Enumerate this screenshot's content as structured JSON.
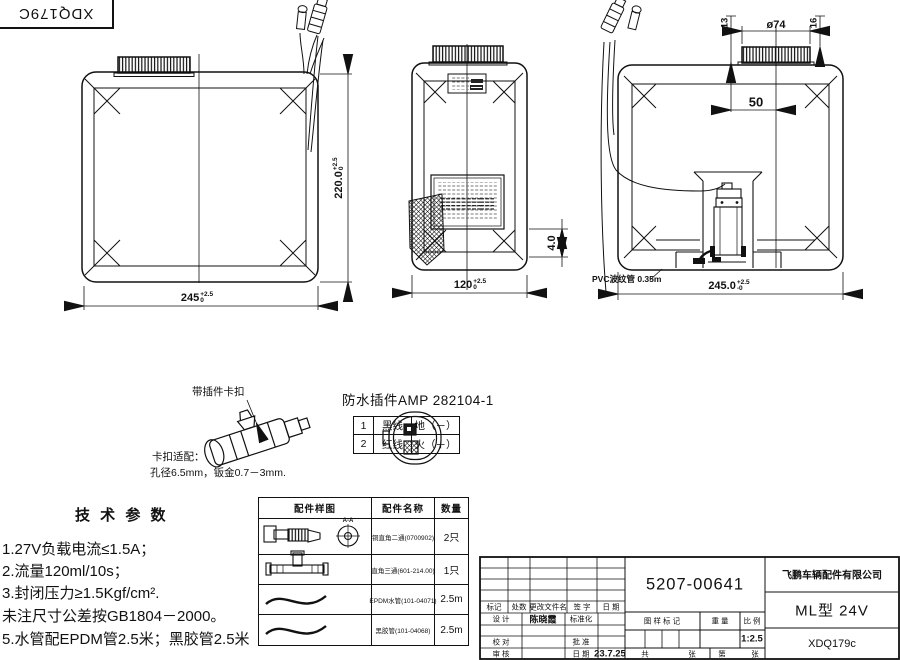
{
  "doc_code": "XDQ179C",
  "views": {
    "front": {
      "dim_width": "245",
      "dim_width_tol_up": "+2.5",
      "dim_width_tol_dn": "0",
      "dim_height": "220.0",
      "dim_height_tol_up": "+2.5",
      "dim_height_tol_dn": "0"
    },
    "side": {
      "dim_width": "120",
      "dim_width_tol_up": "+2.5",
      "dim_width_tol_dn": "0",
      "dim_foot": "4.0"
    },
    "rear": {
      "dim_offset_left": "13",
      "dim_cap_dia": "ø74",
      "dim_offset_right": "16",
      "dim_cap_center": "50",
      "dim_width": "245.0",
      "dim_width_tol_up": "+2.5",
      "dim_width_tol_dn": "-0",
      "pvc_note": "PVC波纹管 0.35m"
    }
  },
  "connector": {
    "clip_label": "带插件卡扣",
    "title": "防水插件AMP 282104-1",
    "pin_rows": [
      {
        "no": "1",
        "wire": "黑线",
        "polarity": "地（－）"
      },
      {
        "no": "2",
        "wire": "红线",
        "polarity": "火（＋）"
      }
    ],
    "fit_title": "卡扣适配：",
    "fit_spec": "孔径6.5mm，钣金0.7－3mm."
  },
  "tech_params": {
    "title": "技 术 参 数",
    "lines": [
      "1.27V负载电流≤1.5A；",
      "2.流量120ml/10s；",
      "3.封闭压力≥1.5Kgf/cm².",
      "未注尺寸公差按GB1804－2000。",
      "5.水管配EPDM管2.5米；黑胶管2.5米"
    ]
  },
  "parts_table": {
    "col_sample": "配件样图",
    "col_name": "配件名称",
    "col_qty": "数量",
    "section_label": "A-A",
    "rows": [
      {
        "name": "铜直角二通(0700902)",
        "qty": "2只"
      },
      {
        "name": "直角三通(601-214.00)",
        "qty": "1只"
      },
      {
        "name": "EPDM水管(101-04071)",
        "qty": "2.5m"
      },
      {
        "name": "黑胶管(101-04068)",
        "qty": "2.5m"
      }
    ]
  },
  "title_block": {
    "drawing_no": "5207-00641",
    "company": "飞鹏车辆配件有限公司",
    "model": "ML型 24V",
    "code": "XDQ179c",
    "col_mark": "标记",
    "col_count": "处数",
    "col_file": "更改文件名",
    "col_sign": "签 字",
    "col_date": "日 期",
    "design": "设 计",
    "designer": "陈晓霞",
    "standardize": "标准化",
    "check": "校 对",
    "approve": "批 准",
    "audit": "审 核",
    "date": "日 期",
    "date_value": "23.7.25",
    "mark_label": "图 样 标 记",
    "weight_label": "重 量",
    "scale_label": "比 例",
    "scale_value": "1:2.5",
    "total_label": "共",
    "total_unit": "张",
    "no_label": "第",
    "no_unit": "张"
  }
}
